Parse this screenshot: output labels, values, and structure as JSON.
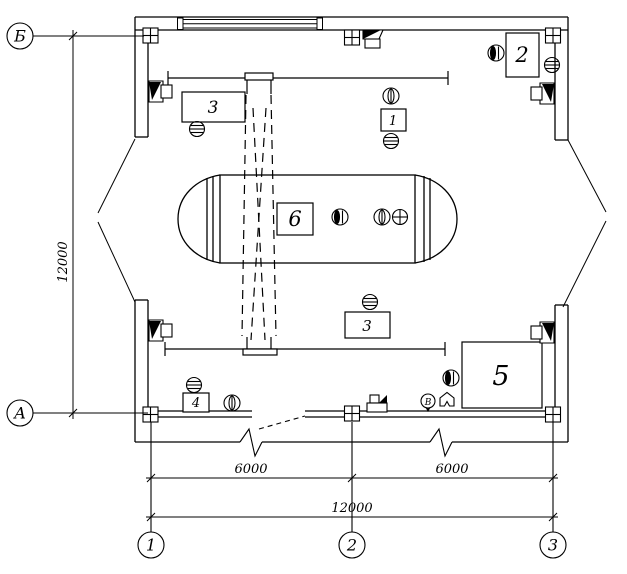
{
  "drawing": {
    "kind": "industrial-building-equipment-floor-plan",
    "colors": {
      "line": "#000000",
      "background": "#ffffff"
    },
    "axes": {
      "rows": [
        {
          "label": "Б"
        },
        {
          "label": "А"
        }
      ],
      "cols": [
        {
          "label": "1"
        },
        {
          "label": "2"
        },
        {
          "label": "3"
        }
      ]
    },
    "dimensions": {
      "left_total": "12000",
      "span_1_2": "6000",
      "span_2_3": "6000",
      "bottom_total": "12000"
    },
    "equipment": {
      "item1": "1",
      "item2": "2",
      "item3_top": "3",
      "item3_bottom": "3",
      "item4": "4",
      "item5": "5",
      "item6": "6"
    },
    "symbols": {
      "circle_b_letter": "В"
    }
  }
}
